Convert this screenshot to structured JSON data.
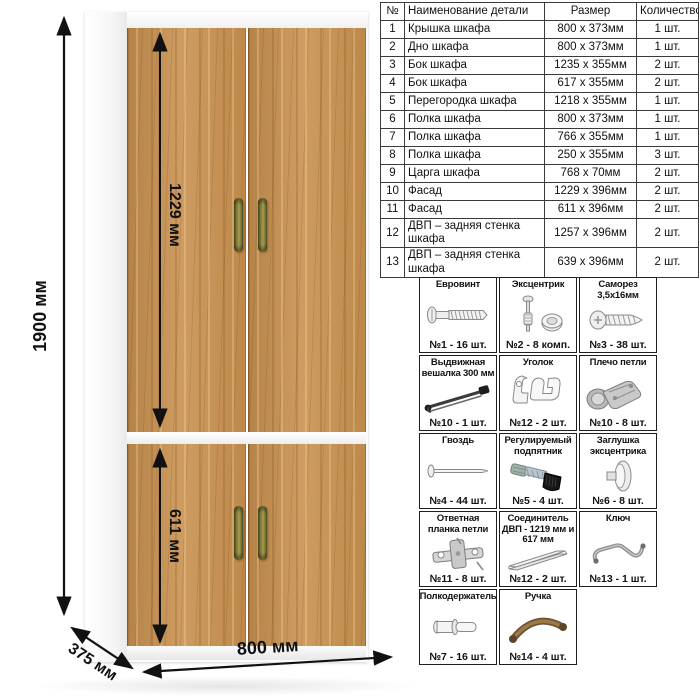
{
  "dimensions": {
    "height_total": "1900 мм",
    "top_door_height": "1229 мм",
    "bottom_door_height": "611 мм",
    "width": "800 мм",
    "depth": "375 мм"
  },
  "parts_table": {
    "headers": {
      "num": "№",
      "name": "Наименование детали",
      "size": "Размер",
      "qty": "Количество"
    },
    "rows": [
      {
        "num": "1",
        "name": "Крышка шкафа",
        "size": "800 x 373мм",
        "qty": "1 шт."
      },
      {
        "num": "2",
        "name": "Дно шкафа",
        "size": "800 x 373мм",
        "qty": "1 шт."
      },
      {
        "num": "3",
        "name": "Бок шкафа",
        "size": "1235 x 355мм",
        "qty": "2 шт."
      },
      {
        "num": "4",
        "name": "Бок шкафа",
        "size": "617 x 355мм",
        "qty": "2 шт."
      },
      {
        "num": "5",
        "name": "Перегородка шкафа",
        "size": "1218 x 355мм",
        "qty": "1 шт."
      },
      {
        "num": "6",
        "name": "Полка шкафа",
        "size": "800 x 373мм",
        "qty": "1 шт."
      },
      {
        "num": "7",
        "name": "Полка шкафа",
        "size": "766 x 355мм",
        "qty": "1 шт."
      },
      {
        "num": "8",
        "name": "Полка шкафа",
        "size": "250 x 355мм",
        "qty": "3 шт."
      },
      {
        "num": "9",
        "name": "Царга шкафа",
        "size": "768 x 70мм",
        "qty": "2 шт."
      },
      {
        "num": "10",
        "name": "Фасад",
        "size": "1229 x 396мм",
        "qty": "2 шт."
      },
      {
        "num": "11",
        "name": "Фасад",
        "size": "611 x 396мм",
        "qty": "2 шт."
      },
      {
        "num": "12",
        "name": "ДВП – задняя стенка шкафа",
        "size": "1257 x 396мм",
        "qty": "2 шт."
      },
      {
        "num": "13",
        "name": "ДВП – задняя стенка шкафа",
        "size": "639 x 396мм",
        "qty": "2 шт."
      }
    ]
  },
  "hardware": {
    "cells": [
      {
        "title": "Евровинт",
        "count": "№1 - 16 шт.",
        "icon": "euro-screw-icon"
      },
      {
        "title": "Эксцентрик",
        "count": "№2 - 8 комп.",
        "icon": "eccentric-cam-icon"
      },
      {
        "title": "Саморез 3,5х16мм",
        "count": "№3 - 38 шт.",
        "icon": "self-tapping-screw-icon"
      },
      {
        "title": "Выдвижная вешалка 300 мм",
        "count": "№10 - 1 шт.",
        "icon": "pullout-hanger-icon"
      },
      {
        "title": "Уголок",
        "count": "№12 - 2 шт.",
        "icon": "corner-bracket-icon"
      },
      {
        "title": "Плечо петли",
        "count": "№10 - 8 шт.",
        "icon": "hinge-arm-icon"
      },
      {
        "title": "Гвоздь",
        "count": "№4 - 44 шт.",
        "icon": "nail-icon"
      },
      {
        "title": "Регулируемый подпятник",
        "count": "№5 - 4 шт.",
        "icon": "adjustable-foot-icon"
      },
      {
        "title": "Заглушка эксцентрика",
        "count": "№6 - 8 шт.",
        "icon": "cam-cap-icon"
      },
      {
        "title": "Ответная планка петли",
        "count": "№11 - 8 шт.",
        "icon": "hinge-plate-icon"
      },
      {
        "title": "Соединитель ДВП - 1219 мм и 617 мм",
        "count": "№12 - 2 шт.",
        "icon": "hdf-connector-icon"
      },
      {
        "title": "Ключ",
        "count": "№13 - 1 шт.",
        "icon": "hex-key-icon"
      },
      {
        "title": "Полкодержатель",
        "count": "№7 - 16 шт.",
        "icon": "shelf-pin-icon"
      },
      {
        "title": "Ручка",
        "count": "№14 - 4 шт.",
        "icon": "handle-icon"
      }
    ]
  },
  "colors": {
    "oak": "#c9914f",
    "handle_bronze": "#8d8a3e",
    "line": "#111111"
  }
}
